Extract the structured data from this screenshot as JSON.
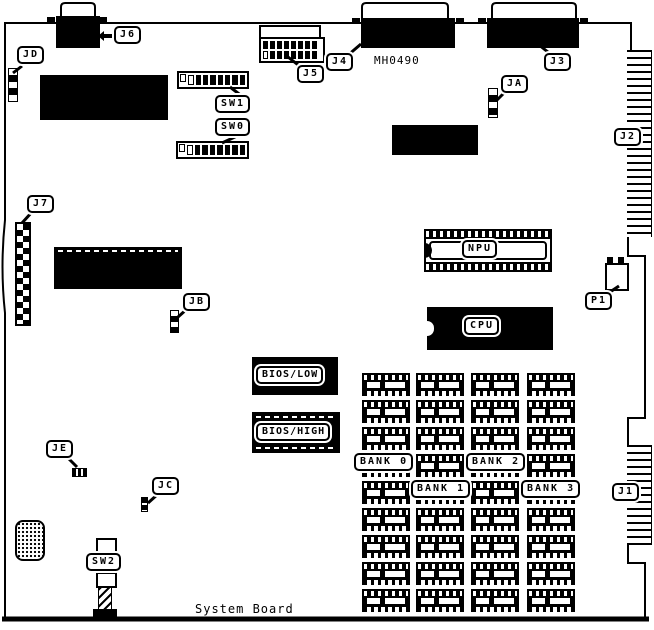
{
  "board": {
    "name": "System Board",
    "part_number": "MH0490"
  },
  "labels": {
    "jd": "JD",
    "j6": "J6",
    "j5": "J5",
    "j4": "J4",
    "j3": "J3",
    "ja": "JA",
    "j2": "J2",
    "j1": "J1",
    "j7": "J7",
    "jb": "JB",
    "jc": "JC",
    "je": "JE",
    "p1": "P1",
    "sw0": "SW0",
    "sw1": "SW1",
    "sw2": "SW2",
    "npu": "NPU",
    "cpu": "CPU",
    "bios_low": "BIOS/LOW",
    "bios_high": "BIOS/HIGH",
    "bank0": "BANK 0",
    "bank1": "BANK 1",
    "bank2": "BANK 2",
    "bank3": "BANK 3"
  },
  "colors": {
    "ink": "#000000",
    "board": "#ffffff"
  }
}
